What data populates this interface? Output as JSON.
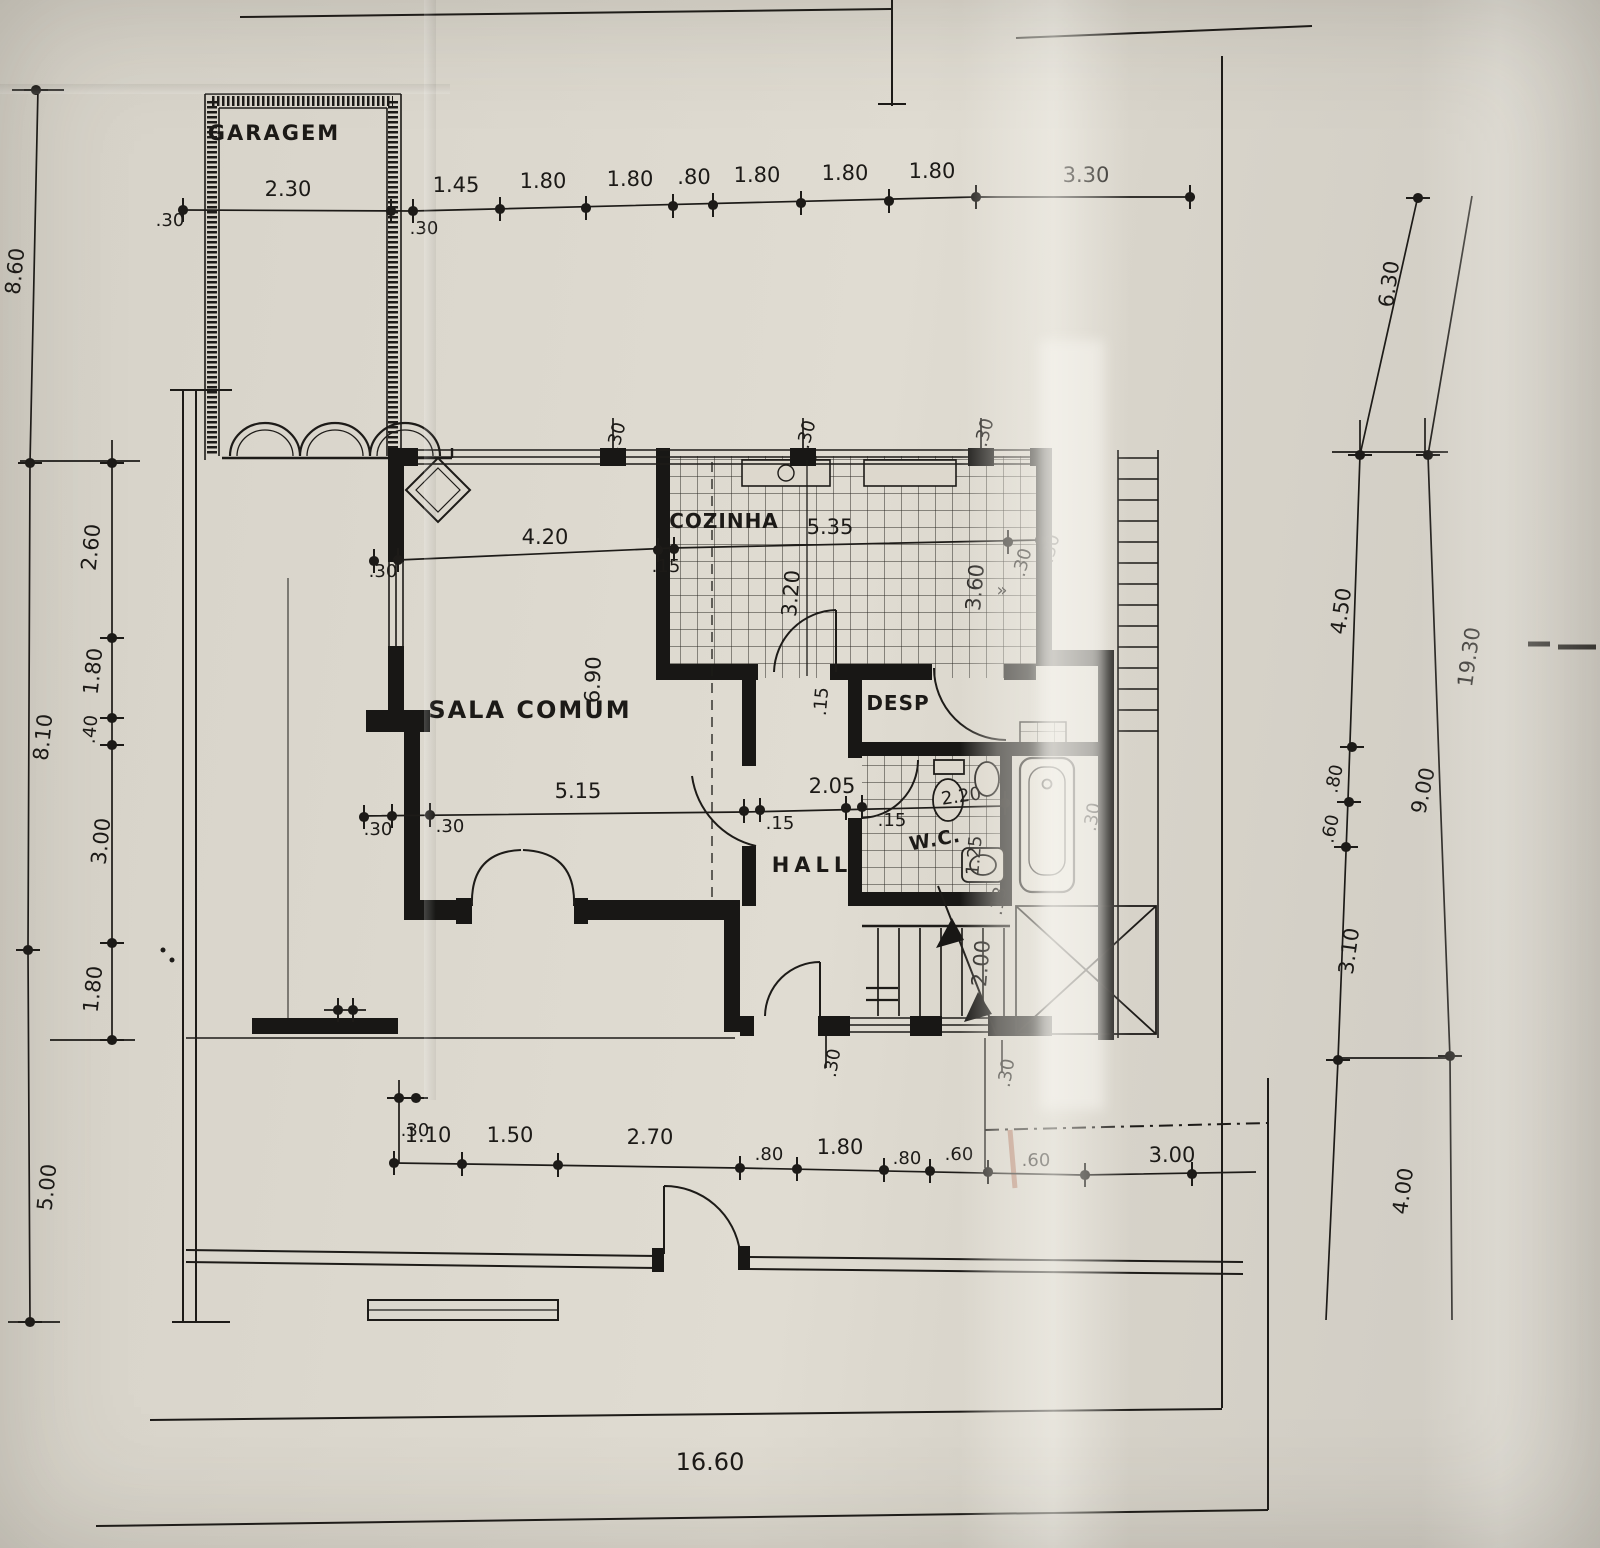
{
  "rooms": {
    "garage": "GARAGEM",
    "living_room": "SALA COMUM",
    "kitchen": "COZINHA",
    "hall": "HALL",
    "pantry": "DESP",
    "wc": "W.C."
  },
  "dimensions": {
    "top_row": [
      "2.30",
      "1.45",
      "1.80",
      "1.80",
      ".80",
      "1.80",
      "1.80",
      "1.80",
      "3.30"
    ],
    "left_outer": [
      "8.60",
      "8.10",
      "5.00"
    ],
    "left_inner": [
      "2.60",
      "1.80",
      ".40",
      "3.00",
      "1.80"
    ],
    "right_inner": [
      "6.30",
      "4.50",
      ".80",
      ".60",
      "3.10",
      "4.00"
    ],
    "right_outer_total": "19.30",
    "right_outer_partial": "9.00",
    "bottom_row": [
      "1.10",
      "1.50",
      "2.70",
      ".80",
      "1.80",
      ".80",
      ".60",
      ".60",
      "3.00"
    ],
    "bottom_total": "16.60",
    "living_width": "4.20",
    "living_depth": "6.90",
    "living_lower_width": "5.15",
    "hall_width": "2.05",
    "kitchen_width": "5.35",
    "kitchen_depth": "3.20",
    "kitchen_right_depth": "3.60",
    "wc_width": "2.20",
    "wc_depth": "1.25",
    "stair_width": "2.00",
    "wall_30": ".30",
    "wall_15": ".15",
    "wall_13": ".13"
  },
  "symbols": {
    "window_chevron": "»"
  }
}
